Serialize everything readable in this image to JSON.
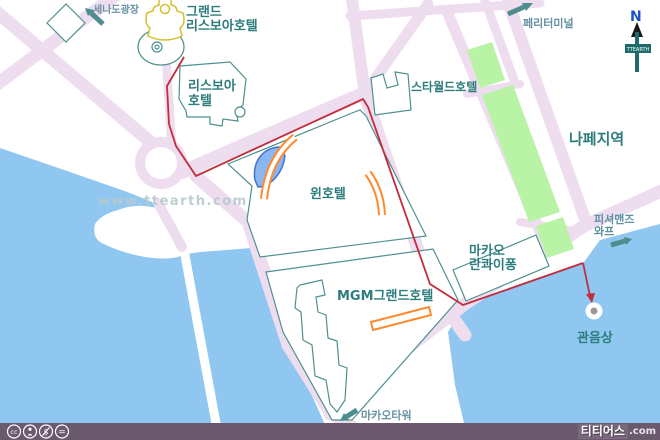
{
  "map": {
    "labels": {
      "senado": "세나도광장",
      "grand_lisboa_line1": "그랜드",
      "grand_lisboa_line2": "리스보아호텔",
      "lisboa_line1": "리스보아",
      "lisboa_line2": "호텔",
      "starworld": "스타월드호텔",
      "ferry_terminal": "페리터미널",
      "nape": "나페지역",
      "wynn": "윈호텔",
      "mgm": "MGM그랜드호텔",
      "lkf_line1": "마카오",
      "lkf_line2": "란콰이퐁",
      "fisherman_line1": "피셔맨즈",
      "fisherman_line2": "와프",
      "kunim_statue": "관음상",
      "macau_tower": "마카오타워"
    },
    "compass": {
      "north": "N",
      "brand": "TTEARTH"
    },
    "watermark": "www.ttearth.com"
  },
  "footer": {
    "brand": "티티어스",
    "suffix": ".com",
    "license_icons": [
      "cc-icon",
      "by-icon",
      "nc-icon",
      "nd-icon"
    ]
  },
  "colors": {
    "water": "#8fc7f0",
    "road": "#eeddee",
    "land": "#ffffff",
    "park_green": "#b9f3a5",
    "building_stroke": "#4f9090",
    "label_teal": "#2e7d7d",
    "label_gray": "#6792a2",
    "route_red": "#c22c3c",
    "hotel_orange": "#ff8a2e",
    "lake_blue": "#8ab7f2",
    "lisboa_yellow": "#d4c030",
    "footer_bar": "#6b5a6e",
    "compass_teal": "#1d6b6b",
    "north_blue": "#1a52cc",
    "statue_gray": "#9a9a9a"
  }
}
